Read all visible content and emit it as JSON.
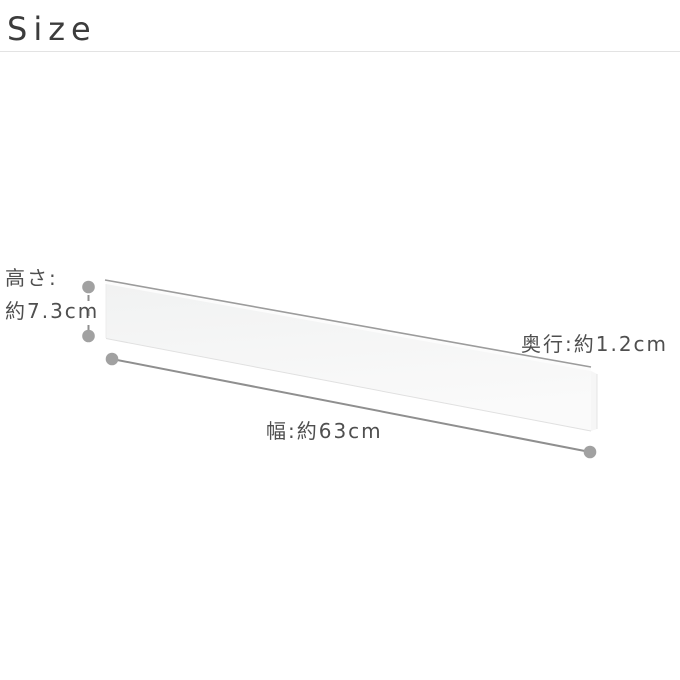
{
  "header": {
    "title": "Size"
  },
  "diagram": {
    "labels": {
      "height_line1": "高さ:",
      "height_line2": "約7.3cm",
      "width": "幅:約63cm",
      "depth": "奥行:約1.2cm"
    },
    "colors": {
      "title_text": "#3c3c3c",
      "label_text": "#4f4f4f",
      "divider": "#e3e3e3",
      "dot": "#a1a1a1",
      "measure_line": "#8f8f8f",
      "panel_edge": "#9c9c9c",
      "panel_face_top": "#f1f2f2",
      "panel_face_bottom": "#fafafa",
      "panel_top_sliver": "#fcfcfc",
      "panel_side": "#f6f6f6",
      "panel_bottom_edge": "#e0e0e0",
      "panel_left_edge": "#ececec",
      "panel_side_edge": "#e4e4e4"
    }
  }
}
